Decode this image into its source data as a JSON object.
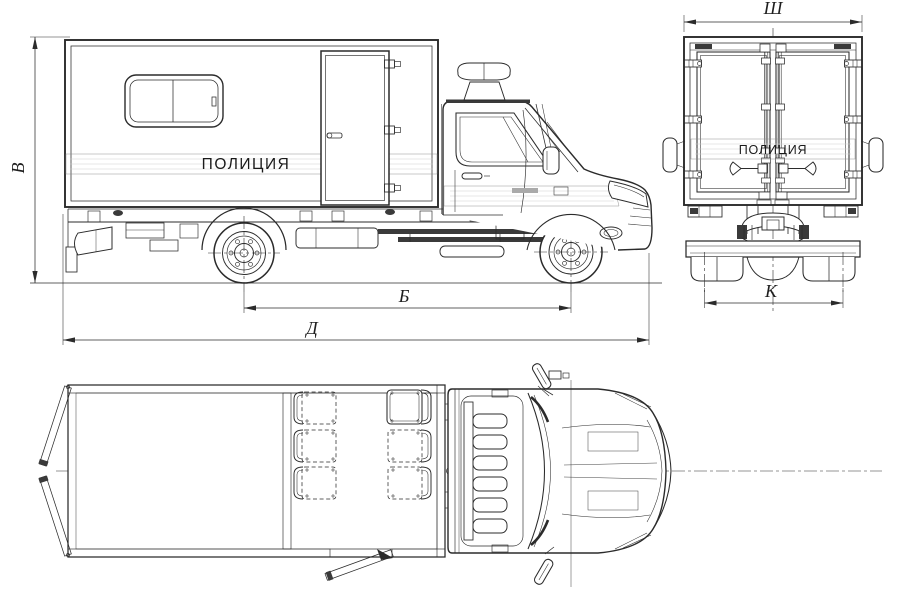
{
  "document": {
    "type": "technical-drawing",
    "subject": "Police box truck — side, rear and plan orthographic views"
  },
  "labels": {
    "police_side": "ПОЛИЦИЯ",
    "police_rear": "ПОЛИЦИЯ"
  },
  "dimensions": {
    "height": "В",
    "body_width": "Ш",
    "wheelbase": "Б",
    "overall_length": "Д",
    "rear_track": "К"
  },
  "colors": {
    "line": "#2b2b2b",
    "stripe_fill": "#e7e7e7",
    "background": "#ffffff"
  }
}
